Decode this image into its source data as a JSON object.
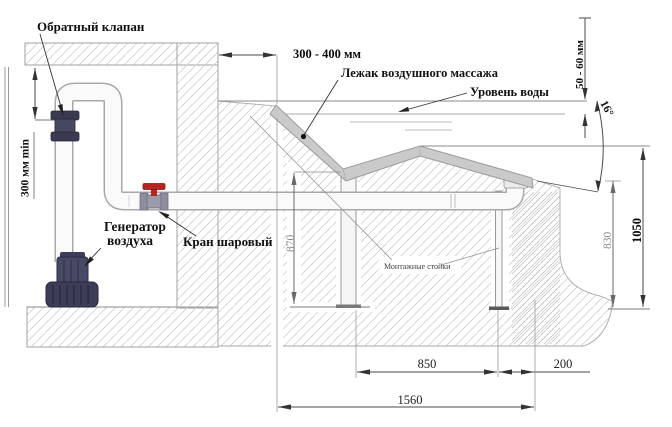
{
  "diagram": {
    "title_hint": "Схема установки лежака воздушного массажа",
    "labels": {
      "check_valve": "Обратный клапан",
      "air_generator_1": "Генератор",
      "air_generator_2": "воздуха",
      "ball_valve": "Кран шаровый",
      "lounger": "Лежак воздушного массажа",
      "water_level": "Уровень воды",
      "mounting_stands": "Монтажные стойки"
    },
    "dimensions": {
      "wall_offset": "300 - 400 мм",
      "loop_height": "300 мм min",
      "water_gap": "50 - 60 мм",
      "angle": "16°",
      "seat_height": "870",
      "foot_height": "830",
      "knee_height": "1050",
      "span_850": "850",
      "span_200": "200",
      "span_1560": "1560"
    },
    "colors": {
      "valve_handle_red": "#b42420",
      "equipment_navy": "#44445f",
      "pipe_white": "#fafafa",
      "pipe_edge": "#a8a8a8",
      "hatch_gray": "#cfcfcf",
      "lounger_gray": "#cacaca",
      "dimension_line": "#4a4a4a",
      "dim_text_gray": "#8a8a8a"
    }
  }
}
